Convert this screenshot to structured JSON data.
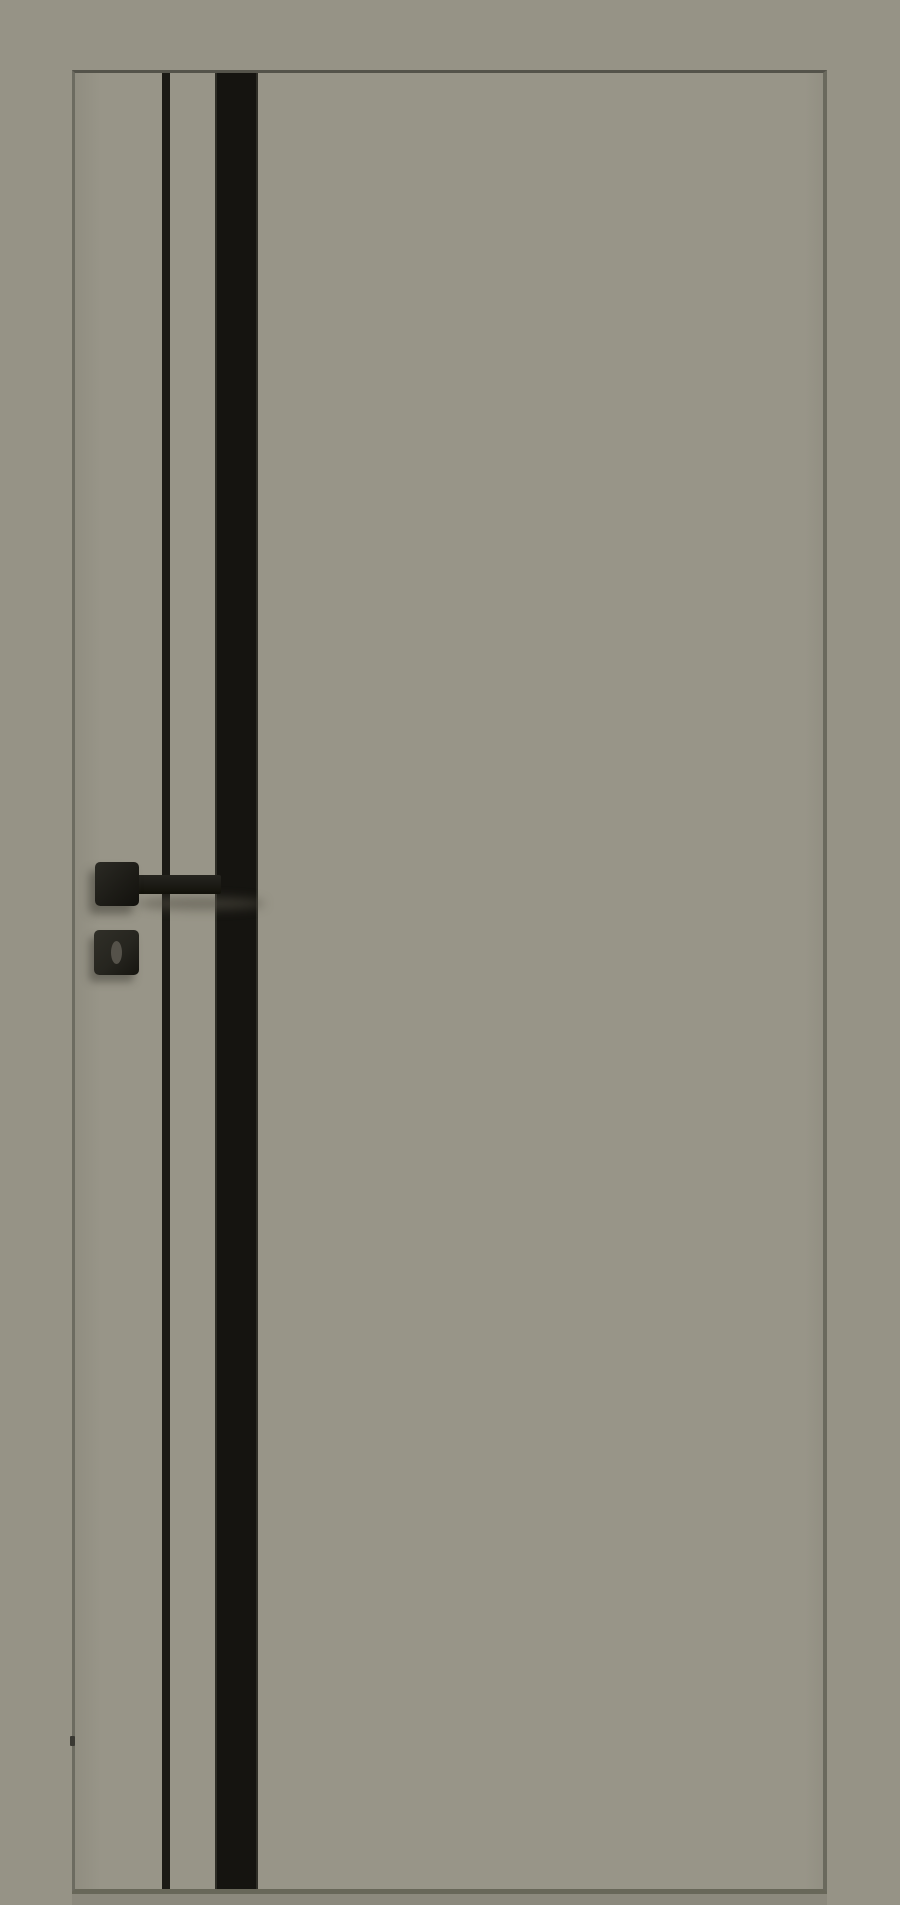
{
  "scene": {
    "description": "Studio product photograph of a modern frameless interior door in a matte grey-olive (stone) finish, viewed straight on against a wall of the same colour",
    "door": {
      "finish": "matte grey-olive",
      "elements": {
        "thin_molding": "thin black vertical aluminium molding running full height near the handle stile",
        "glass_insert": "wide black glass vertical insert running full height",
        "handle": "black square-rose lever handle, lever pointing right toward the glass insert",
        "wc_turn": "black square WC thumb-turn escutcheon below the handle with oval slot",
        "floor_shadow": "narrow dark shadow band under the door leaf",
        "latch_mark": "small dark magnetic-latch mark on the left door edge near the bottom"
      }
    }
  },
  "colors": {
    "background": "#969386",
    "door_face": "#989588",
    "edge_top": "#54534a",
    "edge_left": "#6c6b60",
    "edge_right": "#6a695d",
    "edge_bottom": "#686759",
    "stripe_thin": "#1b1a15",
    "glass_insert": "#151410",
    "glass_edge": "#2e2d26",
    "hardware_black": "#1d1c17",
    "wc_rose": "#26251f",
    "thumbturn_slot": "#55524a",
    "shadow_band": "#8c897d",
    "latch_mark": "#3a3933",
    "soft_shadow": "rgba(84,81,70,0.55)"
  }
}
